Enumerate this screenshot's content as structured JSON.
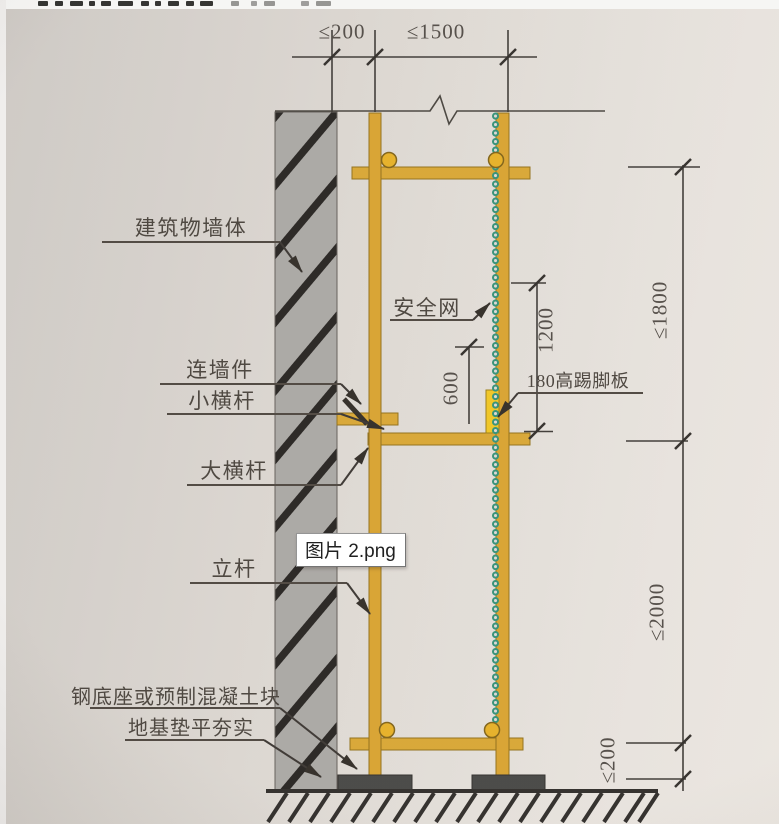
{
  "image_overlay": {
    "filename": "图片 2.png"
  },
  "diagram": {
    "labels": {
      "building_wall": "建筑物墙体",
      "wall_tie": "连墙件",
      "small_ledger": "小横杆",
      "main_ledger": "大横杆",
      "standing_pole": "立杆",
      "steel_base": "钢底座或预制混凝土块",
      "foundation": "地基垫平夯实",
      "safety_net": "安全网",
      "toe_board": "180高踢脚板"
    },
    "dimensions": {
      "top_wall_offset": "≤200",
      "top_bay_width": "≤1500",
      "safety_net_height": "1200",
      "guard_height": "600",
      "right_upper_spacing": "≤1800",
      "right_lower_spacing": "≤2000",
      "right_base_height": "≤200"
    },
    "colors": {
      "scaffold_yellow": "#d7a42f",
      "toe_board_yellow": "#efc41f",
      "safety_net_green": "#2f8e74",
      "wall_gray": "#a8a5a1",
      "base_block_gray": "#434340",
      "paper": "#ddd8d2",
      "ink": "#3a352f"
    }
  }
}
